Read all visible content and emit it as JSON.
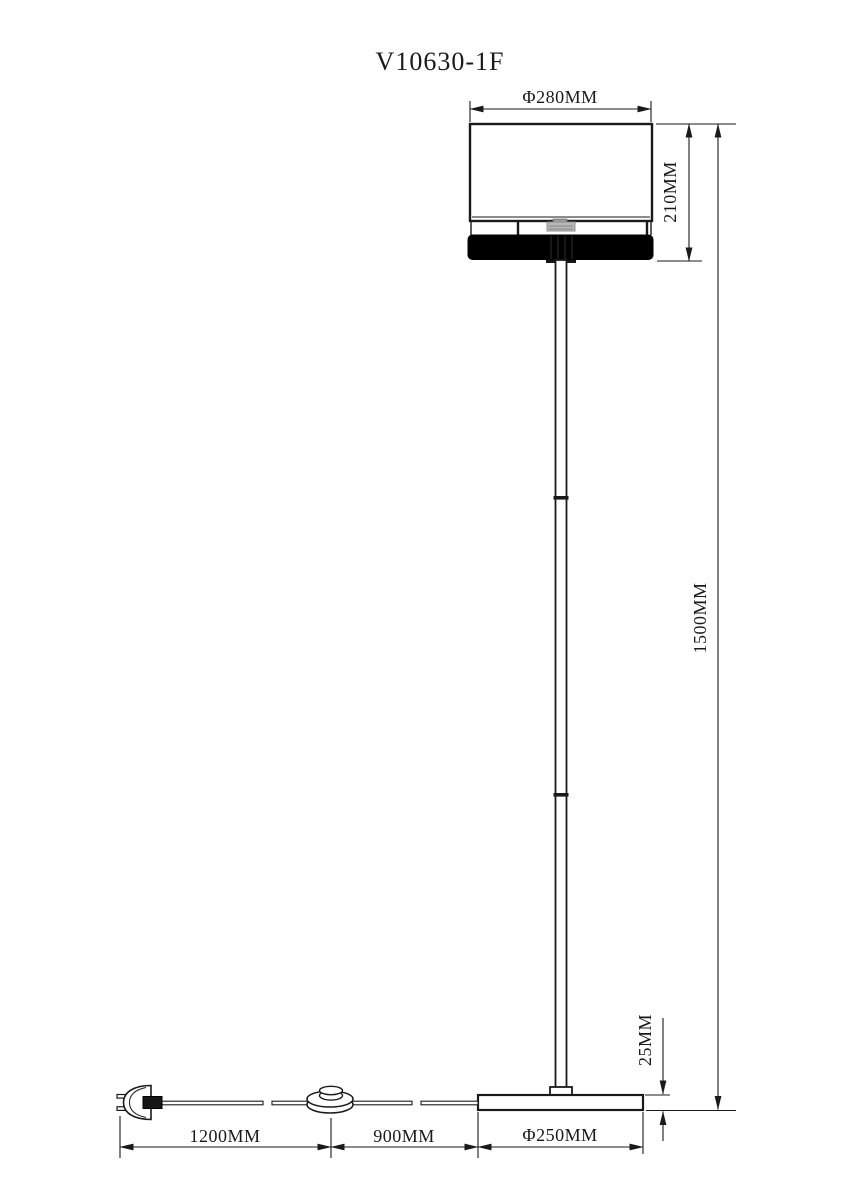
{
  "drawing": {
    "title": "V10630-1F",
    "subject": "floor-lamp-technical-drawing",
    "background_color": "#ffffff",
    "line_color": "#1a1a1a",
    "shade_band_color": "#000000",
    "dimensions": {
      "shade_diameter": "Φ280MM",
      "shade_assembly_height": "210MM",
      "total_height": "1500MM",
      "base_thickness": "25MM",
      "cord_plug_to_switch": "1200MM",
      "cord_switch_to_base": "900MM",
      "base_diameter": "Φ250MM"
    }
  }
}
